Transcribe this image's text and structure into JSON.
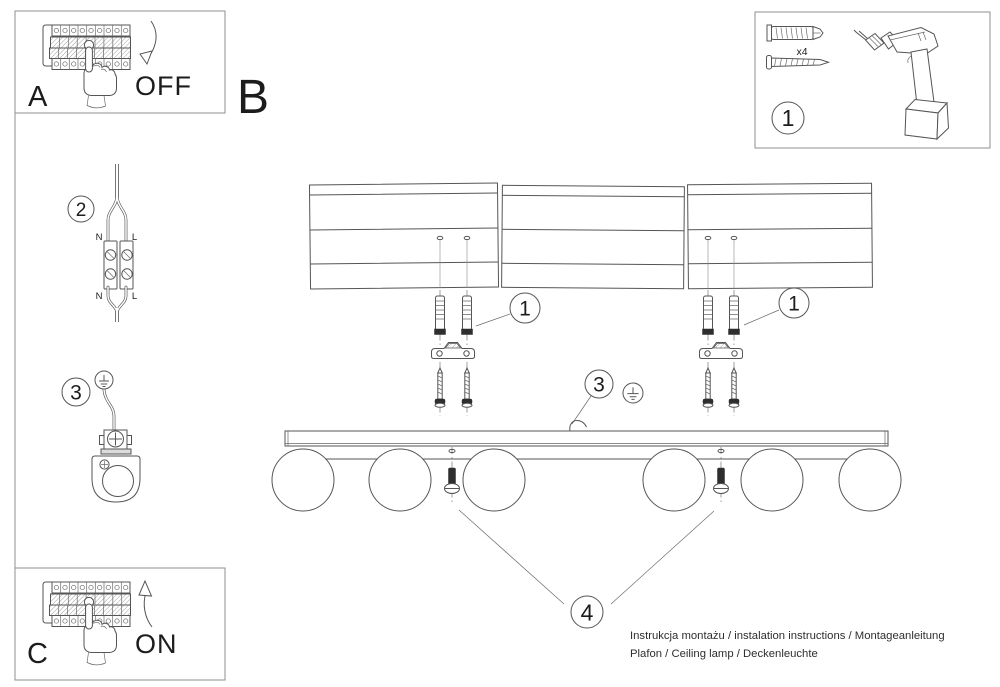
{
  "colors": {
    "line": "#555555",
    "dark_fill": "#2e2e2e",
    "text": "#1c1c1c",
    "background": "#ffffff"
  },
  "panel_a": {
    "label": "A",
    "state": "OFF"
  },
  "main_label": "B",
  "tools": {
    "step": "1",
    "screw_count": "x4"
  },
  "wiring": {
    "step": "2",
    "n_top": "N",
    "l_top": "L",
    "n_bottom": "N",
    "l_bottom": "L"
  },
  "grounding": {
    "step": "3"
  },
  "mounting": {
    "anchors_left": "1",
    "anchors_right": "1",
    "ground": "3",
    "screws": "4"
  },
  "panel_c": {
    "label": "C",
    "state": "ON"
  },
  "footer": {
    "line1": "Instrukcja montażu / instalation instructions / Montageanleitung",
    "line2": "Plafon / Ceiling lamp / Deckenleuchte"
  }
}
